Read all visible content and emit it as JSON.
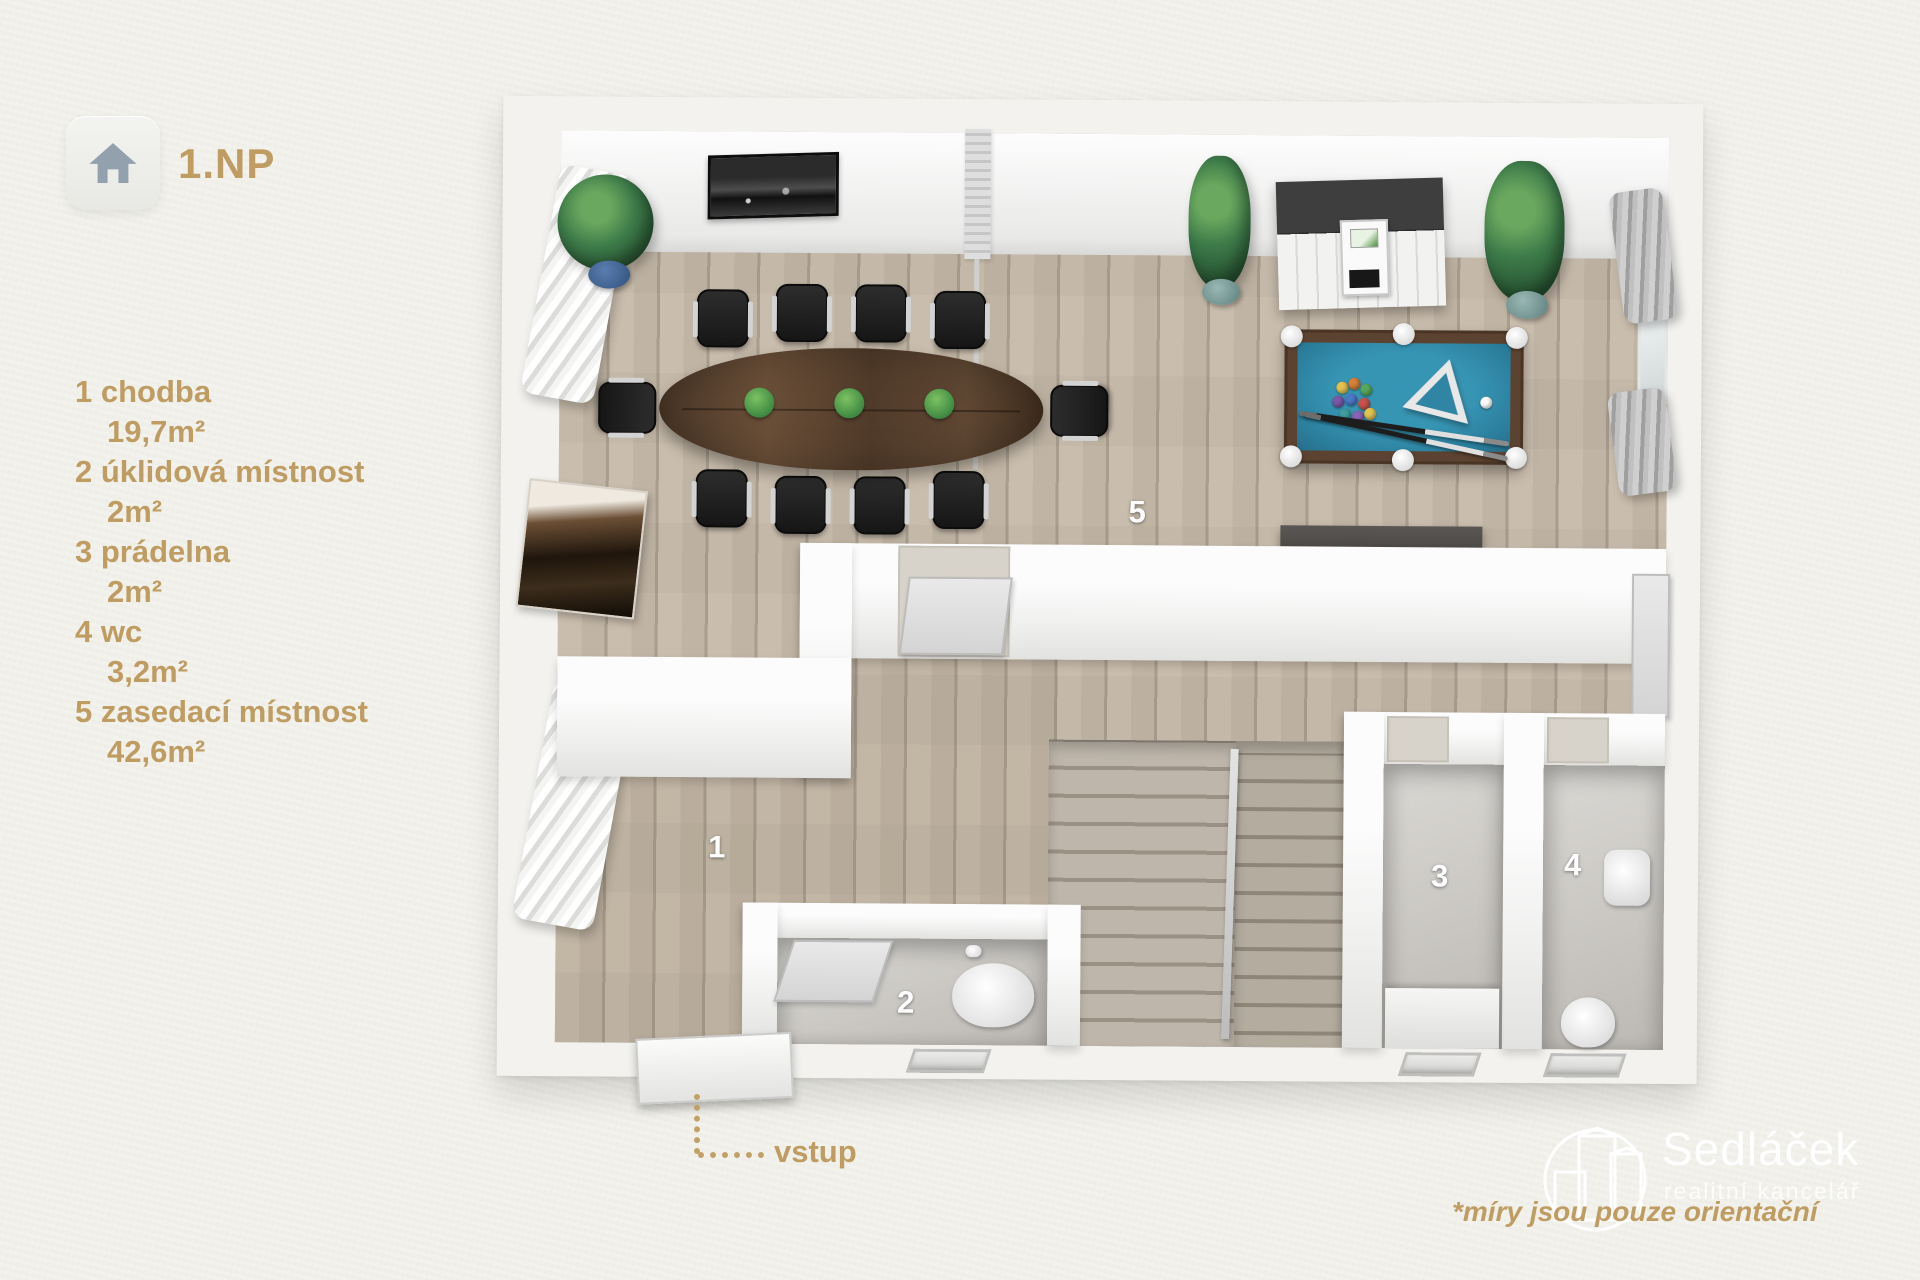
{
  "floor_badge": {
    "label": "1.NP",
    "icon": "home-icon"
  },
  "legend": {
    "rooms": [
      {
        "number": "1",
        "name": "chodba",
        "area": "19,7m²"
      },
      {
        "number": "2",
        "name": "úklidová místnost",
        "area": "2m²"
      },
      {
        "number": "3",
        "name": "prádelna",
        "area": "2m²"
      },
      {
        "number": "4",
        "name": "wc",
        "area": "3,2m²"
      },
      {
        "number": "5",
        "name": "zasedací místnost",
        "area": "42,6m²"
      }
    ]
  },
  "plan": {
    "labels": {
      "hallway": "1",
      "cleaning_room": "2",
      "laundry": "3",
      "wc": "4",
      "meeting_room": "5"
    },
    "entrance_label": "vstup"
  },
  "footer": {
    "disclaimer": "*míry jsou pouze orientační",
    "brand": {
      "name": "Sedláček",
      "tagline": "realitní kancelář",
      "icon": "buildings-logo-icon"
    }
  },
  "colors": {
    "accent_tan": "#bf9c61",
    "background": "#f0efe9",
    "wall_white": "#f2f1ef",
    "floor_wood": "#c4b8a8",
    "tile_gray": "#ccc9c4",
    "pool_felt": "#2e86a4",
    "table_walnut": "#5a4330",
    "plant_green": "#3e7c4a",
    "room_label": "#ffffff"
  }
}
